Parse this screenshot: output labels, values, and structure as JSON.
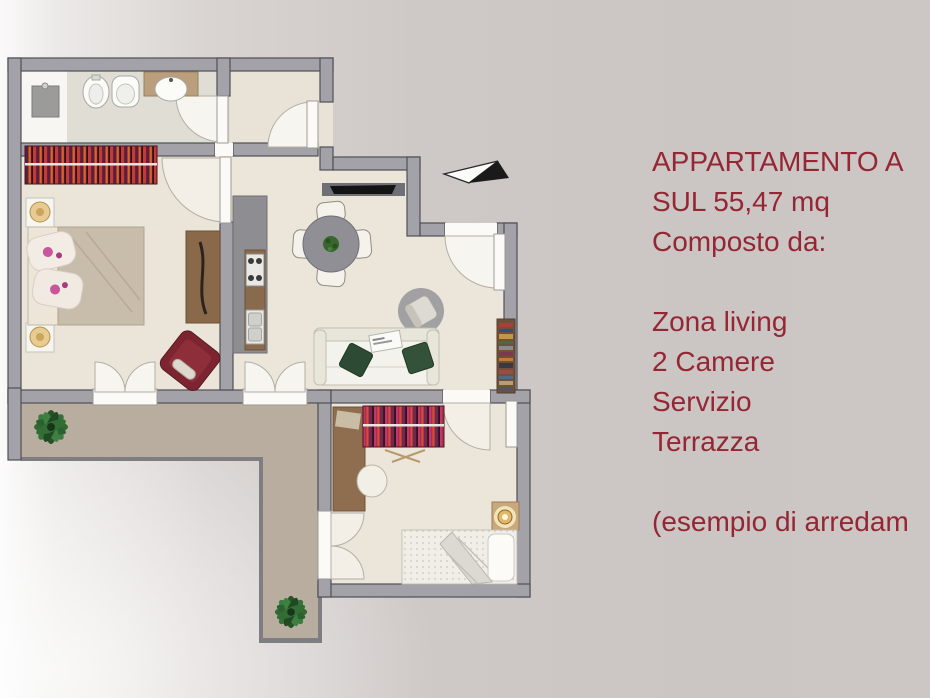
{
  "slide": {
    "kind": "real-estate floor plan presentation",
    "background_right_color": "#cbc5c3",
    "background_left_color": "#fbfafa"
  },
  "description": {
    "text_color": "#942733",
    "lines": [
      "APPARTAMENTO A",
      "SUL 55,47 mq",
      "Composto da:",
      "",
      "Zona living",
      "2 Camere",
      "Servizio",
      "Terrazza",
      "",
      "(esempio di arredam"
    ]
  },
  "floor_plan": {
    "rooms": [
      "bathroom",
      "entry-hall",
      "bedroom-1",
      "kitchen",
      "dining-living-area",
      "bedroom-2",
      "terrace"
    ],
    "icons": [
      "north-arrow-icon",
      "plant-icon"
    ],
    "colors": {
      "wall": "#a2a2a8",
      "wall_outline": "#4f4f55",
      "floor": "#ece6da",
      "bathroom_floor": "#dfddd4",
      "terrace_floor": "#b8ad9e",
      "door_white": "#fbfaf6",
      "furniture_maroon": "#7c2531",
      "wood": "#8a6a4c",
      "plant_green": "#2f6b31",
      "lamp_gold": "#e0b868"
    }
  }
}
